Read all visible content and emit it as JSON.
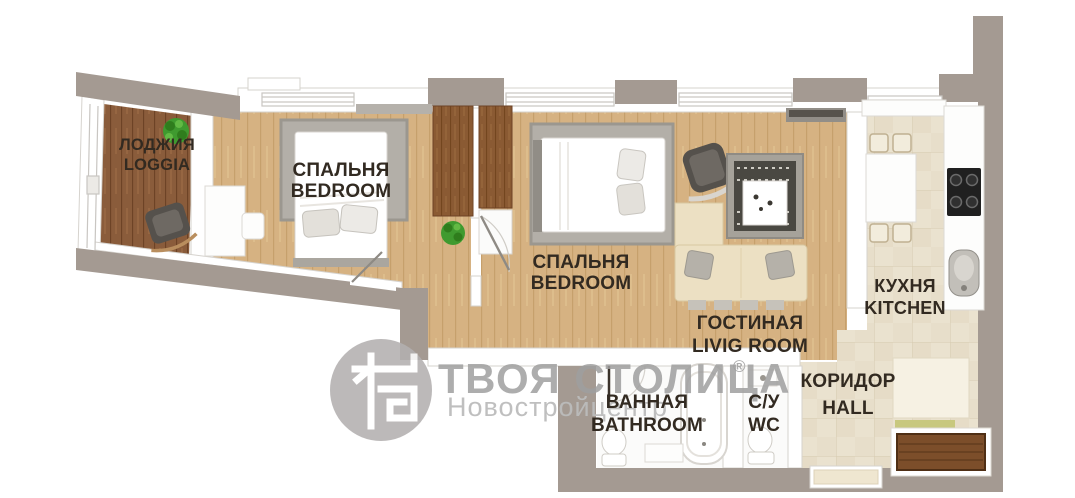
{
  "document": {
    "type": "apartment-floor-plan-render",
    "background": "#ffffff",
    "style": "top-down 3D render, slightly rotated, two-bedroom apartment"
  },
  "rooms": [
    {
      "id": "loggia",
      "label_ru": "ЛОДЖИЯ",
      "label_en": "LOGGIA"
    },
    {
      "id": "bedroom-1",
      "label_ru": "СПАЛЬНЯ",
      "label_en": "BEDROOM"
    },
    {
      "id": "bedroom-2",
      "label_ru": "СПАЛЬНЯ",
      "label_en": "BEDROOM"
    },
    {
      "id": "living-room",
      "label_ru": "ГОСТИНАЯ",
      "label_en": "LIVIG ROOM"
    },
    {
      "id": "kitchen",
      "label_ru": "КУХНЯ",
      "label_en": "KITCHEN"
    },
    {
      "id": "bathroom",
      "label_ru": "ВАННАЯ",
      "label_en": "BATHROOM"
    },
    {
      "id": "wc",
      "label_ru": "С/У",
      "label_en": "WC"
    },
    {
      "id": "hall",
      "label_ru": "КОРИДОР",
      "label_en": "HALL"
    }
  ],
  "watermark": {
    "brand": "ТВОЯ СТОЛИЦА",
    "registered": "®",
    "subtitle": "Новостройцентр",
    "logo_icon": "tvoya-stolitsa-building-logo"
  },
  "palette": {
    "exterior_wall": "#a49a92",
    "interior_wall": "#ffffff",
    "wood_floor": "#d6b282",
    "loggia_floor": "#8a5c3b",
    "tile_floor": "#eae2cf",
    "bath_floor": "#fbfbfa",
    "label_text": "#322a21",
    "watermark_text": "#9f9f9f",
    "watermark_subtext": "#bcbcbc",
    "furniture_brown": "#8a5a33",
    "sofa_cream": "#ece0c3",
    "armchair_gray": "#55514c",
    "rug_gray": "#b3afa8",
    "plant_green": "#3f9a2f",
    "doormat_brown": "#7c4e2a",
    "cooktop_black": "#202020"
  },
  "furniture_icons": [
    "rocking-chair",
    "potted-plant",
    "double-bed",
    "area-rug",
    "desk",
    "desk-chair",
    "wardrobe",
    "open-door",
    "sofa",
    "armchair",
    "coffee-table",
    "patterned-rug",
    "tv-shelf",
    "dining-table",
    "kitchen-chair",
    "kitchen-counter",
    "cooktop",
    "kitchen-sink",
    "bathtub",
    "toilet",
    "washbasin",
    "bathroom-cabinet",
    "hall-closet",
    "doormat",
    "entrance-door"
  ]
}
